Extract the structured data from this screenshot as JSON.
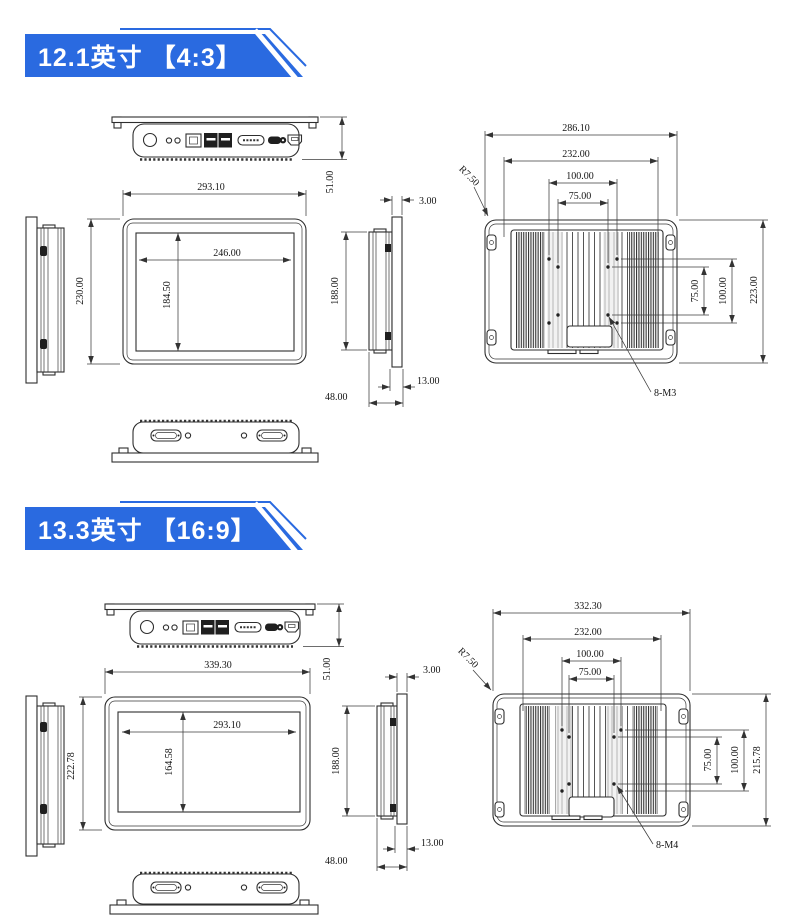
{
  "page": {
    "background": "#ffffff",
    "accent_blue": "#2a6ae0",
    "line_color": "#2e2e2e"
  },
  "sections": [
    {
      "banner_label": "12.1英寸 【4:3】",
      "top_view": {
        "total_thickness": "51.00"
      },
      "front_view": {
        "outer_width": "293.10",
        "outer_height": "230.00",
        "display_width": "246.00",
        "display_height": "184.50"
      },
      "side_view": {
        "panel_thickness": "3.00",
        "body_height": "188.00",
        "mount_depth": "13.00",
        "body_depth": "48.00"
      },
      "rear_view": {
        "outer_width": "286.10",
        "inner_width": "232.00",
        "vesa_width_100": "100.00",
        "vesa_width_75": "75.00",
        "vesa_height_75": "75.00",
        "vesa_height_100": "100.00",
        "outer_height": "223.00",
        "corner_radius": "R7.50",
        "screw_label": "8-M3"
      }
    },
    {
      "banner_label": "13.3英寸 【16:9】",
      "top_view": {
        "total_thickness": "51.00"
      },
      "front_view": {
        "outer_width": "339.30",
        "outer_height": "222.78",
        "display_width": "293.10",
        "display_height": "164.58"
      },
      "side_view": {
        "panel_thickness": "3.00",
        "body_height": "188.00",
        "mount_depth": "13.00",
        "body_depth": "48.00"
      },
      "rear_view": {
        "outer_width": "332.30",
        "inner_width": "232.00",
        "vesa_width_100": "100.00",
        "vesa_width_75": "75.00",
        "vesa_height_75": "75.00",
        "vesa_height_100": "100.00",
        "outer_height": "215.78",
        "corner_radius": "R7.50",
        "screw_label": "8-M4"
      }
    }
  ]
}
